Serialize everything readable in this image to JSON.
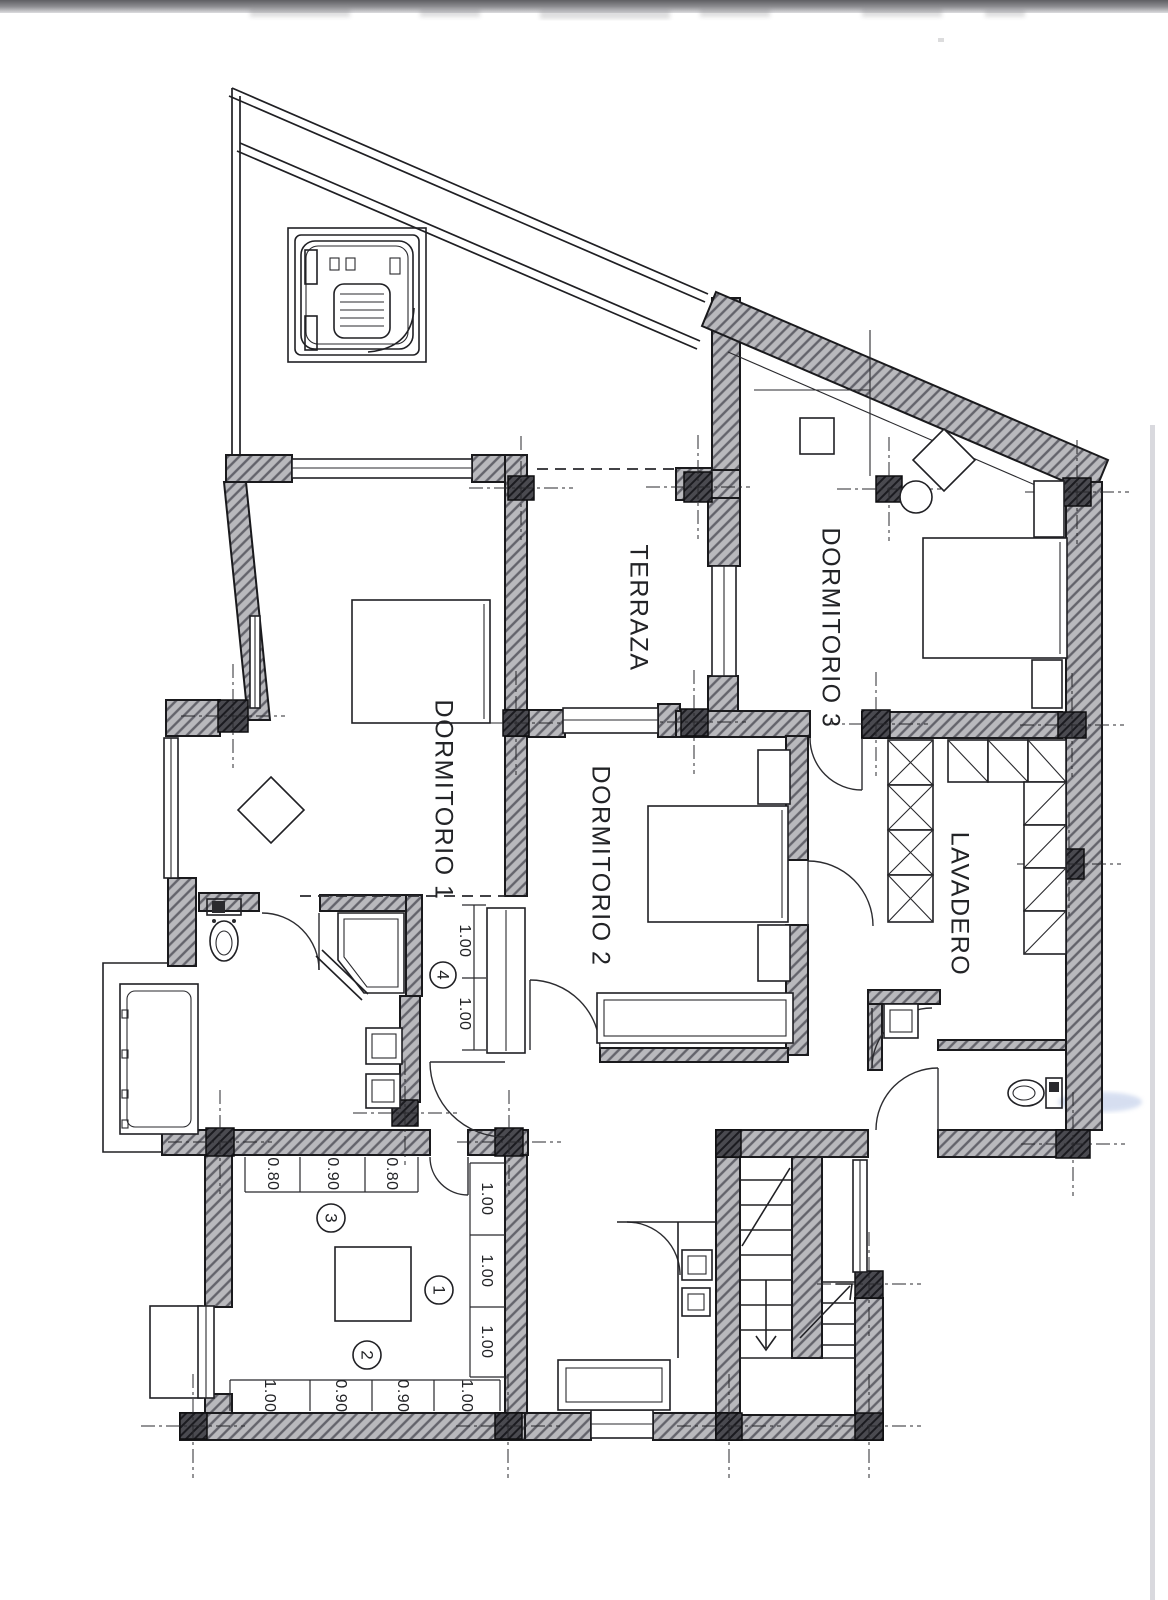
{
  "page": {
    "kind": "scanned architectural floor plan (upper floor)"
  },
  "colors": {
    "ink": "#1d1d20",
    "wall_fill": "#b9b9bd",
    "wall_hatch_line": "#63636b",
    "column_fill": "#4a4a50",
    "scan_band_dark": "#5f5f63",
    "paper_edge": "#cfcfd6",
    "smudge_blue": "#aebfe3"
  },
  "rooms": {
    "terraza": "TERRAZA",
    "dormitorio1": "DORMITORIO 1",
    "dormitorio2": "DORMITORIO 2",
    "dormitorio3": "DORMITORIO 3",
    "lavadero": "LAVADERO"
  },
  "dimensions": {
    "dining_top": [
      "0.80",
      "0.90",
      "0.80"
    ],
    "dining_right": [
      "1.00",
      "1.00",
      "1.00"
    ],
    "dining_bottom": [
      "1.00",
      "0.90",
      "0.90",
      "1.00"
    ],
    "hall": [
      "1.00",
      "1.00"
    ]
  },
  "markers": {
    "m1": "1",
    "m2": "2",
    "m3": "3",
    "m4": "4"
  }
}
